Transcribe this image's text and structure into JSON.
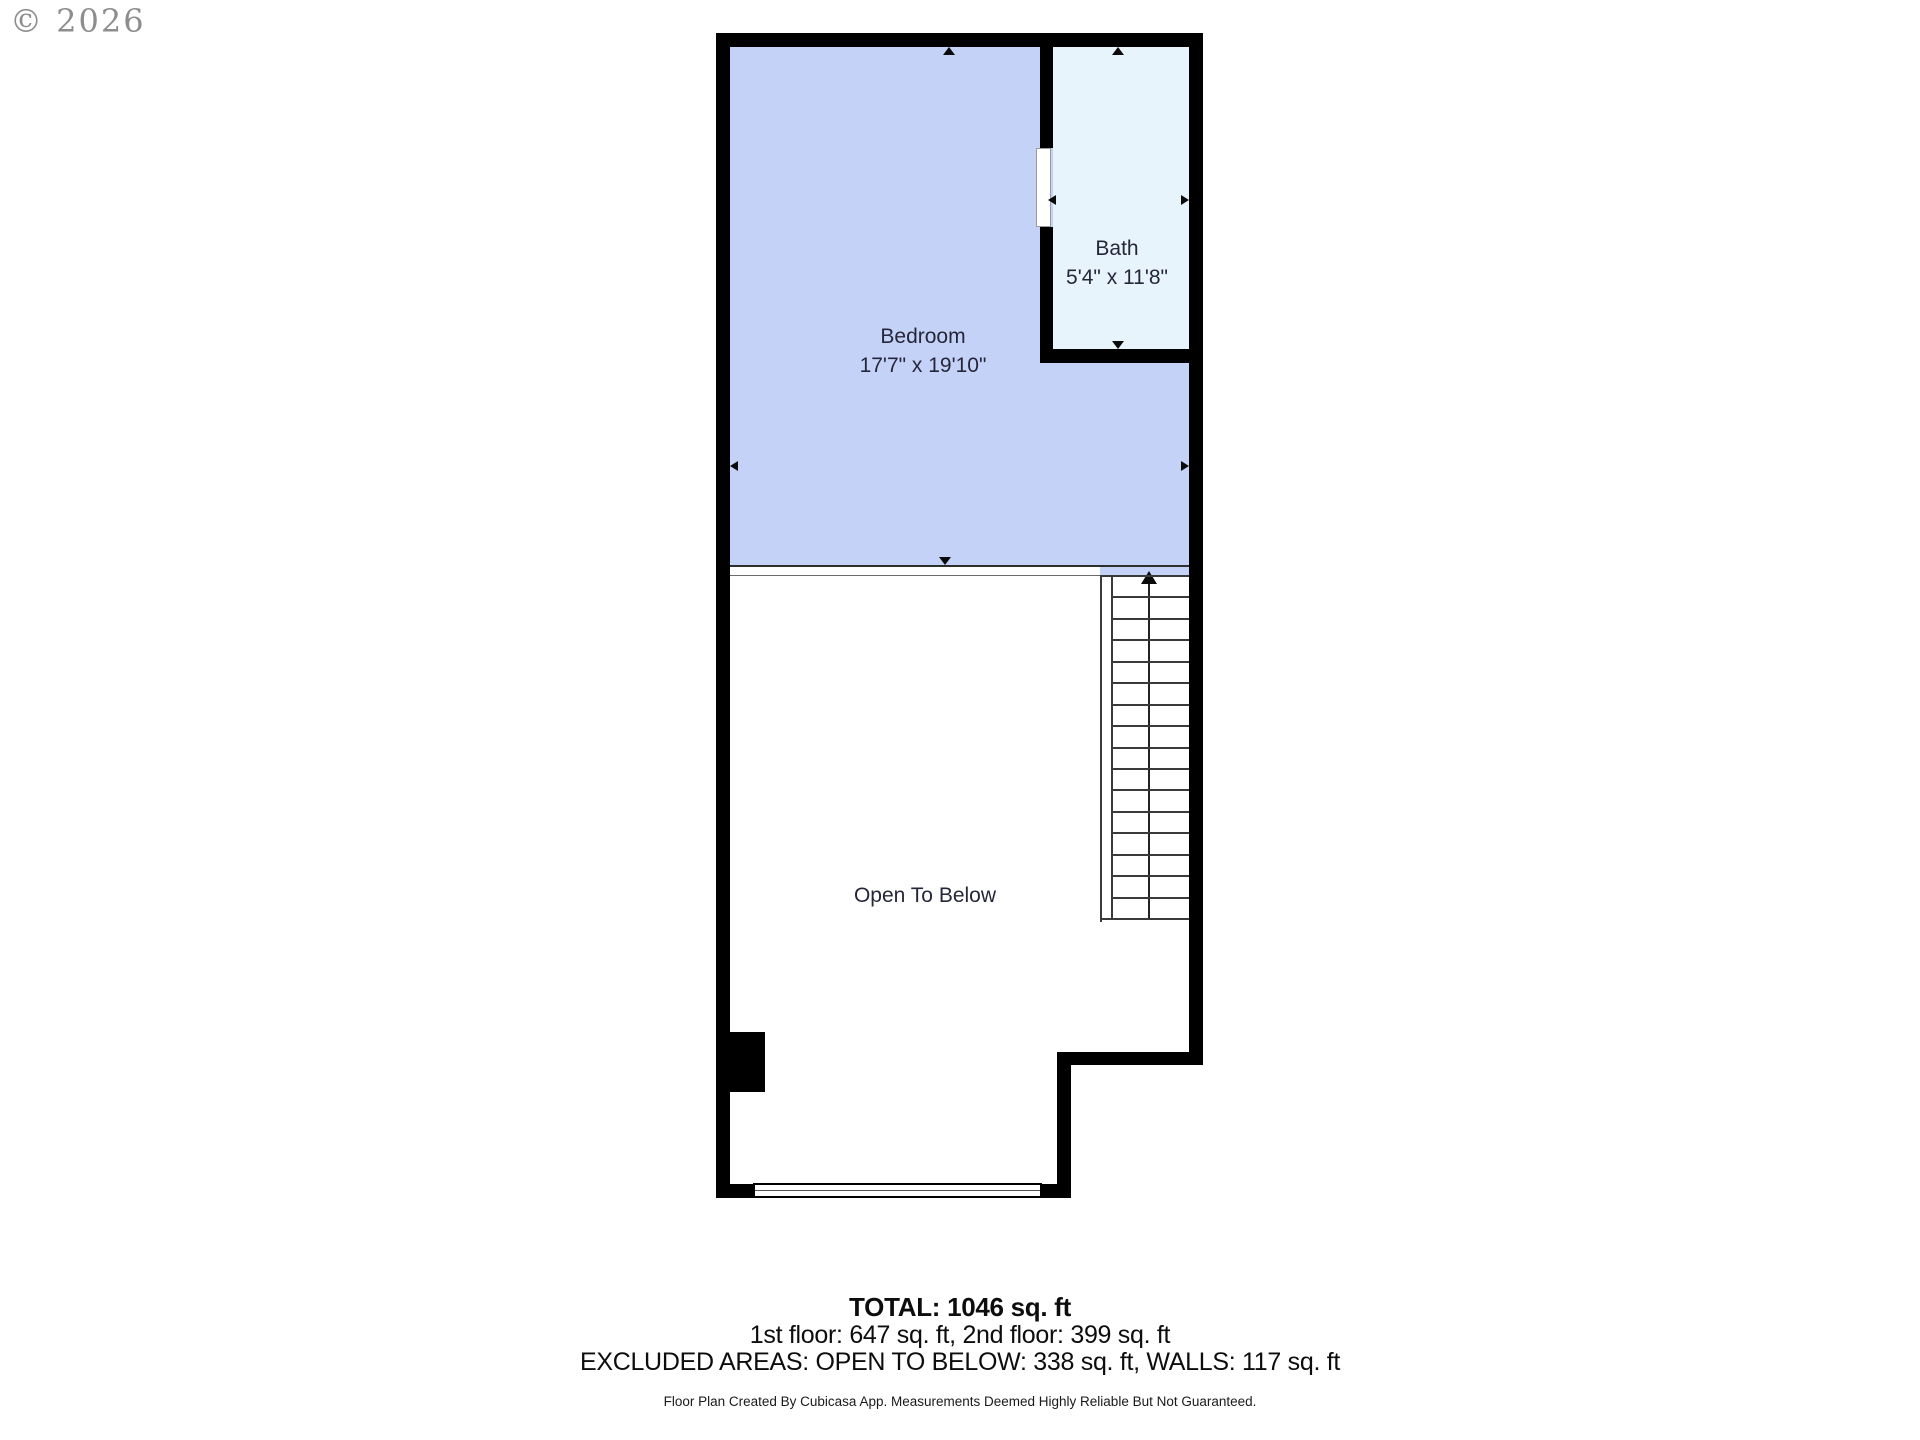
{
  "watermark": {
    "text": "© 2026"
  },
  "rooms": {
    "bedroom": {
      "name": "Bedroom",
      "dimensions": "17'7\" x 19'10\""
    },
    "bath": {
      "name": "Bath",
      "dimensions": "5'4\" x 11'8\""
    },
    "open_to_below": {
      "name": "Open To Below"
    }
  },
  "stairs": {
    "treads": 16
  },
  "summary": {
    "total": "TOTAL: 1046 sq. ft",
    "floors": "1st floor: 647 sq. ft, 2nd floor: 399 sq. ft",
    "excluded": "EXCLUDED AREAS: OPEN TO BELOW: 338 sq. ft, WALLS: 117 sq. ft"
  },
  "footer": {
    "disclaimer": "Floor Plan Created By Cubicasa App. Measurements Deemed Highly Reliable But Not Guaranteed."
  },
  "colors": {
    "wall": "#000000",
    "bedroom_fill": "#c5d2f8",
    "bath_fill": "#e8f4fc",
    "label": "#26263a",
    "line": "#3a3a3a"
  }
}
